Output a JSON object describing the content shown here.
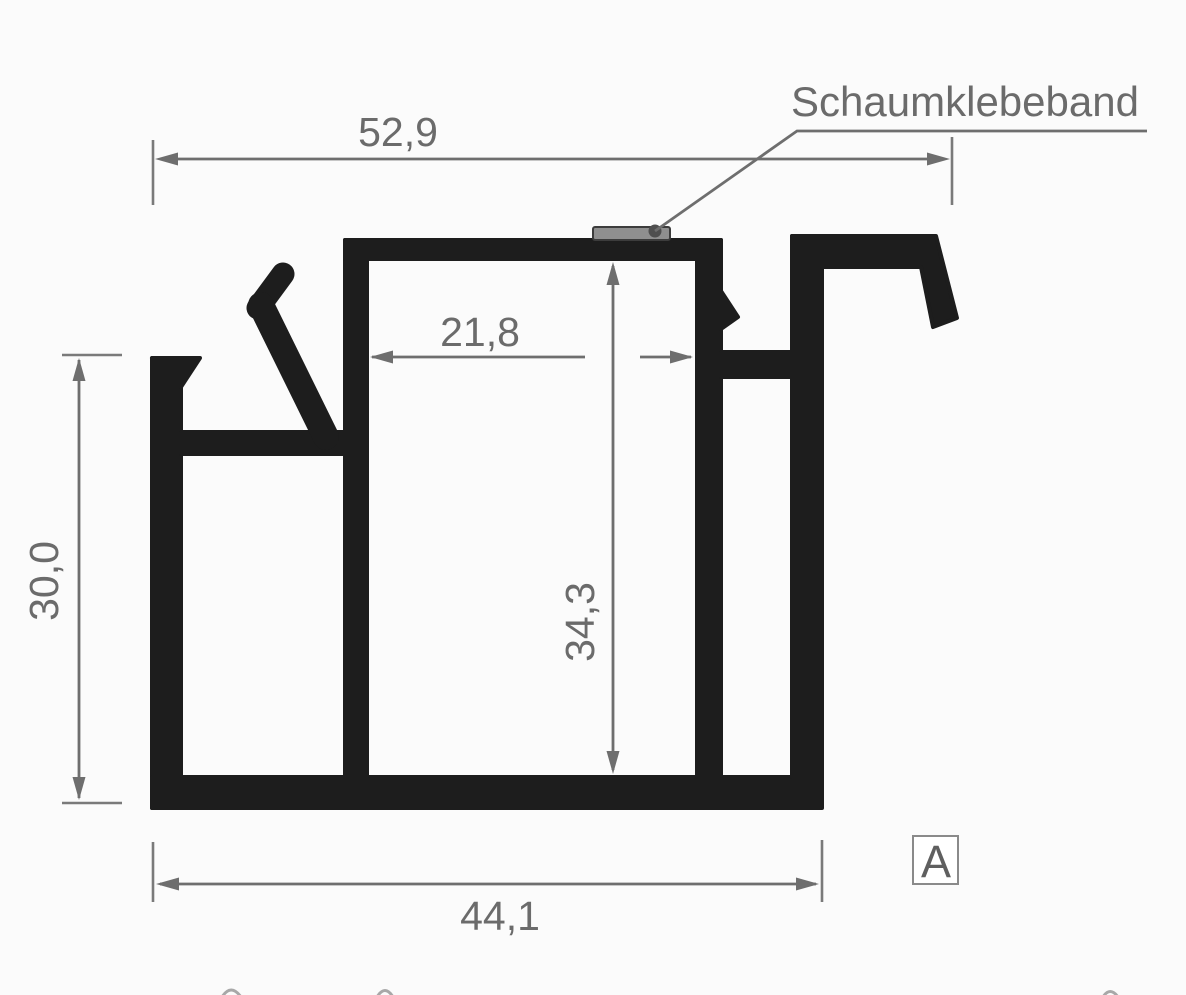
{
  "drawing": {
    "callout": {
      "label": "Schaumklebeband",
      "target": "foam-tape-on-top-rail"
    },
    "section_marker": {
      "label": "A"
    },
    "dimensions": {
      "overall_width": {
        "label": "52,9",
        "value_mm": 52.9,
        "orientation": "horizontal",
        "position": "top"
      },
      "inner_channel_width": {
        "label": "21,8",
        "value_mm": 21.8,
        "orientation": "horizontal",
        "position": "middle"
      },
      "inner_height": {
        "label": "34,3",
        "value_mm": 34.3,
        "orientation": "vertical",
        "position": "center"
      },
      "left_height": {
        "label": "30,0",
        "value_mm": 30.0,
        "orientation": "vertical",
        "position": "left"
      },
      "base_width": {
        "label": "44,1",
        "value_mm": 44.1,
        "orientation": "horizontal",
        "position": "bottom"
      }
    },
    "colors": {
      "profile": "#1d1d1d",
      "dimension_gray": "#6e6e6e",
      "tape_fill": "#8f8f8f",
      "tape_border": "#3c3c3c",
      "section_border": "#8a8a8a",
      "background": "#fbfbfb"
    }
  }
}
